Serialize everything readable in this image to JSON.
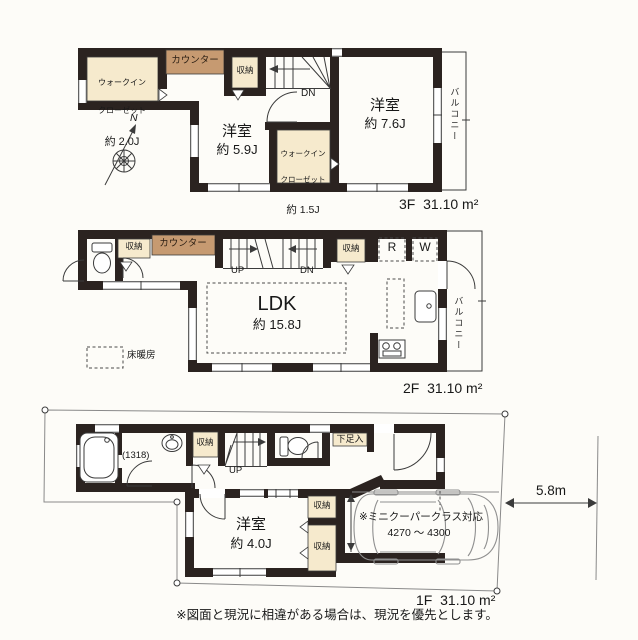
{
  "colors": {
    "wall": "#2b2320",
    "cream": "#f6eacd",
    "counter": "#c69a71",
    "bg": "#fdfcf8"
  },
  "compass": {
    "north_label": "N"
  },
  "floor3": {
    "wic_large": {
      "line1": "ウォークイン",
      "line2": "クローゼット",
      "size": "約 2.0J"
    },
    "counter": "カウンター",
    "storage": "収納",
    "stairs_down": "DN",
    "bedroom_59": {
      "name": "洋室",
      "size": "約 5.9J"
    },
    "wic_small": {
      "line1": "ウォークイン",
      "line2": "クローゼット",
      "size": "約 1.5J"
    },
    "bedroom_76": {
      "name": "洋室",
      "size": "約 7.6J"
    },
    "balcony": "バルコニー",
    "area": "3F  31.10 m²"
  },
  "floor2": {
    "storage_left": "収納",
    "counter": "カウンター",
    "stairs_up": "UP",
    "stairs_down": "DN",
    "storage_right": "収納",
    "refrigerator": "R",
    "washer": "W",
    "ldk": {
      "name": "LDK",
      "size": "約 15.8J"
    },
    "balcony": "バルコニー",
    "floor_heating": "床暖房",
    "area": "2F  31.10 m²"
  },
  "floor1": {
    "bath_size": "(1318)",
    "storage_top": "収納",
    "stairs_up": "UP",
    "shoe_storage": "下足入",
    "storage_mid": "収納",
    "storage_bottom": "収納",
    "bedroom_40": {
      "name": "洋室",
      "size": "約 4.0J"
    },
    "car_note_line1": "※ミニクーパークラス対応",
    "car_note_line2": "4270 〜 4300",
    "site_width": "5.8m",
    "area": "1F  31.10 m²"
  },
  "footer": {
    "disclaimer": "※図面と現況に相違がある場合は、現況を優先とします。"
  }
}
